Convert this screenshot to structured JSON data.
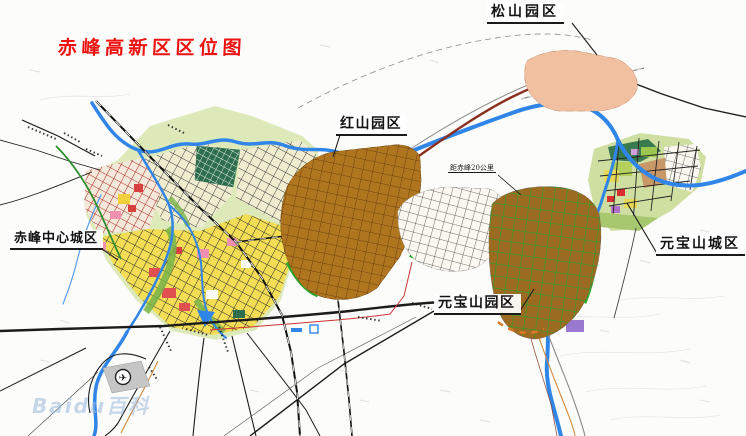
{
  "title": {
    "text": "赤峰高新区区位图"
  },
  "labels": {
    "songshan": "松山园区",
    "hongshan": "红山园区",
    "chifeng_center": "赤峰中心城区",
    "yuanbaoshan_park": "元宝山园区",
    "yuanbaoshan_city": "元宝山城区",
    "distance_note": "距赤峰20公里"
  },
  "watermark": {
    "text": "Baidu百科"
  },
  "icons": {
    "airport": "airplane-in-circle"
  },
  "colors": {
    "title_red": "#ee1311",
    "river_blue": "#2f86e8",
    "zone_boundary_blue": "#1a5fd6",
    "industrial_brown": "#b0761f",
    "residential_yellow": "#f2dd55",
    "red_grid_district": "#b23028",
    "magenta_block": "#e8189a",
    "green_corridor": "#28a828",
    "expressway_maroon": "#8b3020",
    "songshan_blue": "#74b6e8",
    "songshan_peach": "#f0c0a0",
    "watermark_blue": "#9ab8dc"
  }
}
